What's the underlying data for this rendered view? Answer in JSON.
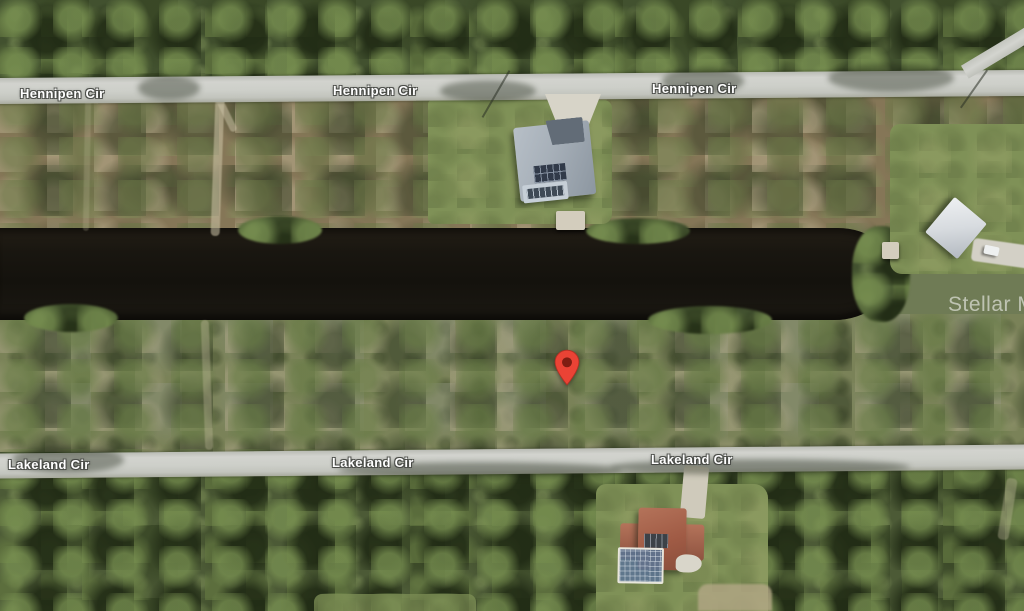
{
  "map": {
    "watermark": {
      "text": "Stellar MLS"
    },
    "street_labels": [
      {
        "id": "hennipen-1",
        "text": "Hennipen Cir"
      },
      {
        "id": "hennipen-2",
        "text": "Hennipen Cir"
      },
      {
        "id": "hennipen-3",
        "text": "Hennipen Cir"
      },
      {
        "id": "lakeland-1",
        "text": "Lakeland Cir"
      },
      {
        "id": "lakeland-2",
        "text": "Lakeland Cir"
      },
      {
        "id": "lakeland-3",
        "text": "Lakeland Cir"
      }
    ],
    "marker": {
      "type": "red-location-pin",
      "fill": "#EA4335",
      "stroke": "#B13024",
      "dot": "#7F1D12"
    },
    "colors": {
      "road": "#CDCFC9",
      "canal_water": "#17140F",
      "tree_canopy_top": "#42512F",
      "tree_canopy_bottom": "#4C5A36",
      "scrub_upper": "#857657",
      "scrub_lower": "#7A8258",
      "lawn": "#7F9157",
      "driveway": "#D7D4C8",
      "roof_house_north": "#A6AFB8",
      "solar_panels": "#313A49",
      "roof_house_south": "#A2604A",
      "pool_enclosure": "#5C7492",
      "roof_house_east": "#DDE0E3",
      "label_text": "#FFFFFF"
    }
  }
}
